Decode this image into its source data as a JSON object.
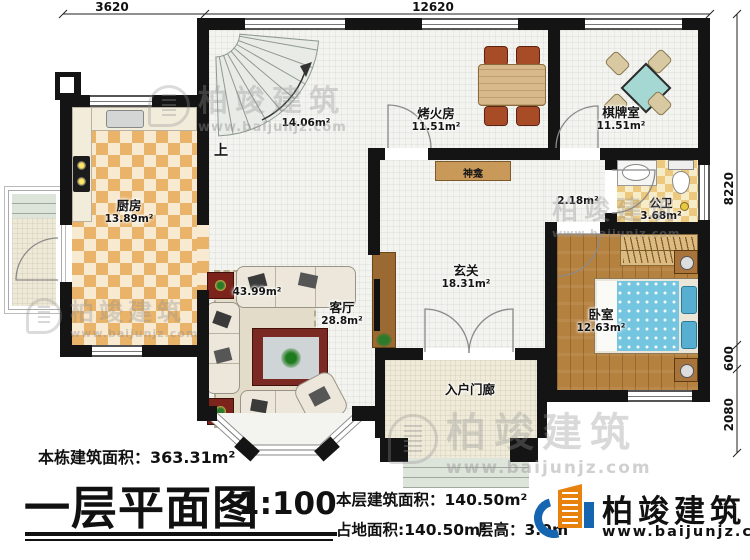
{
  "dimensions": {
    "d3620": "3620",
    "d12620": "12620",
    "d8220": "8220",
    "d600": "600",
    "d2080": "2080"
  },
  "rooms": {
    "stairwell": {
      "area": "14.06m²",
      "up": "上"
    },
    "kitchen": {
      "name": "厨房",
      "area": "13.89m²"
    },
    "fire_room": {
      "name": "烤火房",
      "area": "11.51m²"
    },
    "chess_room": {
      "name": "棋牌室",
      "area": "11.51m²"
    },
    "shrine": {
      "name": "神龛"
    },
    "bathroom": {
      "name": "公卫",
      "area": "3.68m²"
    },
    "corridor": {
      "area": "2.18m²"
    },
    "bedroom": {
      "name": "卧室",
      "area": "12.63m²"
    },
    "foyer": {
      "name": "玄关",
      "area": "18.31m²"
    },
    "living_room": {
      "name": "客厅",
      "area": "28.8m²",
      "combined_area": "43.99m²"
    },
    "entry_porch": {
      "name": "入户门廊"
    }
  },
  "footer": {
    "total_area": "本栋建筑面积：363.31m²",
    "title": "一层平面图",
    "scale": "1:100",
    "floor_area": "本层建筑面积：140.50m²",
    "ground_area": "占地面积:140.50m²",
    "floor_height": "层高：3.0m",
    "brand": "柏竣建筑",
    "brand_url": "www.baijunjz.com"
  },
  "watermark": {
    "text": "柏竣建筑",
    "url": "www.baijunjz.com"
  }
}
